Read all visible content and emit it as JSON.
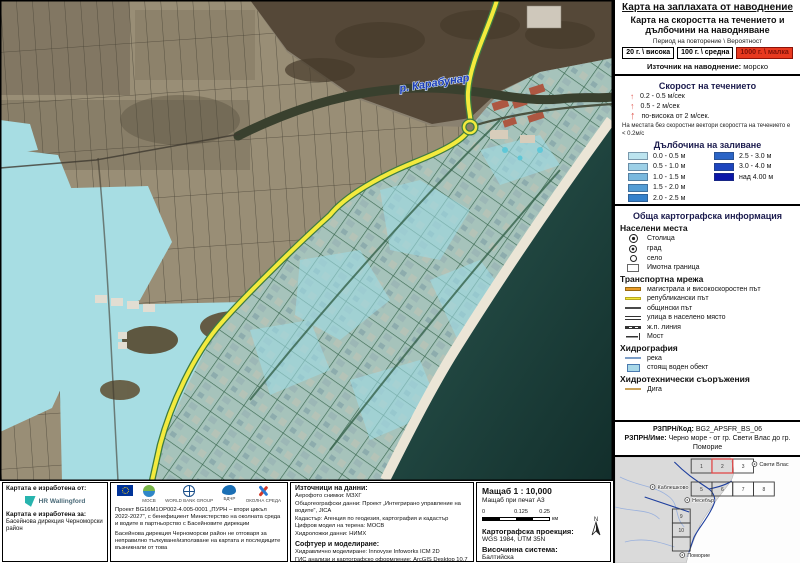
{
  "legend": {
    "title": "Карта на заплахата от наводнение",
    "subtitle": "Карта на скоростта на течението и дълбочини на наводняване",
    "period_label": "Период на повторение \\ Вероятност",
    "period_options": [
      {
        "label": "20 г. \\ висока"
      },
      {
        "label": "100 г. \\ средна"
      },
      {
        "label": "1000 г. \\ малка"
      }
    ],
    "source_label": "Източник на наводнение:",
    "source_value": "морско",
    "velocity": {
      "heading": "Скорост на течението",
      "items": [
        "0.2 - 0.5 м/сек",
        "0.5 - 2 м/сек",
        "по-висока от 2 м/сек."
      ],
      "note": "На местата без скоростни вектори скоростта на течението е < 0.2м/с"
    },
    "depth": {
      "heading": "Дълбочина на заливане",
      "items": [
        {
          "label": "0.0 - 0.5 м",
          "color": "#bce4ef"
        },
        {
          "label": "0.5 - 1.0 м",
          "color": "#9dd0e7"
        },
        {
          "label": "1.0 - 1.5 м",
          "color": "#79b8de"
        },
        {
          "label": "1.5 - 2.0 м",
          "color": "#549dd5"
        },
        {
          "label": "2.0 - 2.5 м",
          "color": "#3581cb"
        },
        {
          "label": "2.5 - 3.0 м",
          "color": "#2b64c6"
        },
        {
          "label": "3.0 - 4.0 м",
          "color": "#1e45be"
        },
        {
          "label": "над 4.00 м",
          "color": "#0b16a8"
        }
      ]
    },
    "carto_heading": "Обща картографска информация",
    "settlements": {
      "heading": "Населени места",
      "items": [
        "Столица",
        "град",
        "село",
        "Имотна граница"
      ]
    },
    "transport": {
      "heading": "Транспортна мрежа",
      "items": [
        "магистрала и високоскоростен път",
        "републикански път",
        "общински път",
        "улица в населено място",
        "ж.п. линия",
        "Мост"
      ]
    },
    "hydrography": {
      "heading": "Хидрография",
      "items": [
        "река",
        "стоящ воден обект"
      ]
    },
    "hydrotech": {
      "heading": "Хидротехнически съоръжения",
      "items": [
        "Дига"
      ]
    },
    "rzprn": {
      "code_label": "РЗПРН/Код:",
      "code": "BG2_APSFR_BS_06",
      "name_label": "РЗПРН/Име:",
      "name": "Черно море - от гр. Свети Влас до гр. Поморие"
    }
  },
  "map": {
    "river_label": "р. Карабунар"
  },
  "inset": {
    "towns": [
      "Свети Влас",
      "Каблешково",
      "Несебър",
      "Поморие"
    ],
    "cells": [
      "1",
      "2",
      "3",
      "5",
      "6",
      "7",
      "8",
      "9",
      "10"
    ]
  },
  "footer": {
    "made_by_label": "Картата е изработена от:",
    "made_by_logo": "HR Wallingford",
    "made_for_label": "Картата е изработена за:",
    "made_for_value": "Басейнова дирекция Черноморски район",
    "logos": {
      "mosv": "МОСВ",
      "world_bank": "WORLD BANK GROUP",
      "bdchr": "БДЧР",
      "env": "ОКОЛНА СРЕДА"
    },
    "project_text": "Проект BG16M1OP002-4.005-0001 „ПУРН – втори цикъл 2022-2027“, с бенефициент Министерство на околната среда и водите в партньорство с Басейновите дирекции",
    "disclaimer_text": "Басейнова дирекция Черноморски район не отговаря за неправилно тълкуване/използване на картата и последиците възникнали от това",
    "sources": {
      "heading": "Източници на данни:",
      "items": [
        "Аерофото снимки: МЗХГ",
        "Общогеографски данни: Проект „Интегрирано управление на водите“, JICA",
        "Кадастър: Агенция по геодезия, картография и кадастър",
        "Цифров модел на терена: МОСВ",
        "Хидроложки данни: НИМХ"
      ]
    },
    "software": {
      "heading": "Софтуер и моделиране:",
      "items": [
        "Хидравлично моделиране: Innovyse Infoworks ICM 2D",
        "ГИС анализи и картографско оформление: ArcGIS Desktop 10.7"
      ]
    },
    "scalebox": {
      "scale": "Мащаб 1 : 10,000",
      "print_scale": "Мащаб при печат А3",
      "ticks": [
        "0",
        "0.125",
        "0.25"
      ],
      "unit": "км",
      "projection_label": "Картографска проекция:",
      "projection_value": "WGS 1984, UTM 35N",
      "elevation_label": "Височинна система:",
      "elevation_value": "Балтийска",
      "north_label": "N"
    }
  }
}
